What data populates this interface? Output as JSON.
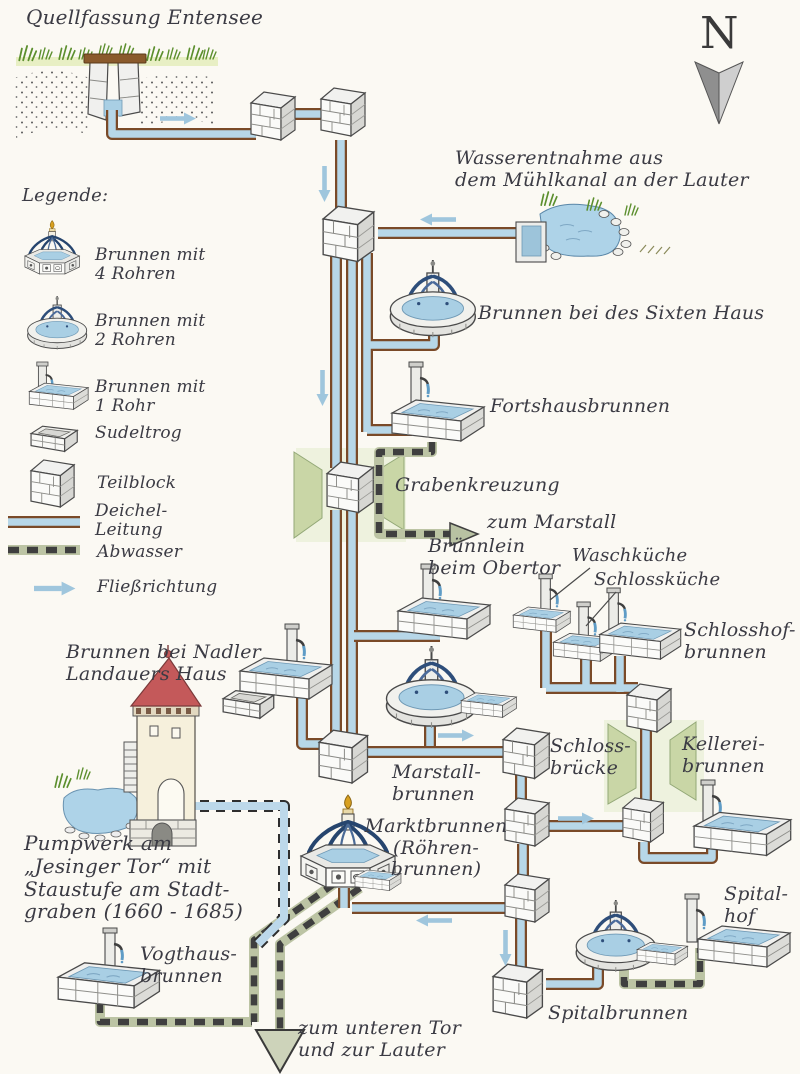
{
  "labels": {
    "quellfassung": "Quellfassung Entensee",
    "wasserentnahme": "Wasserentnahme aus\ndem Mühlkanal an der Lauter",
    "sixten": "Brunnen bei des Sixten Haus",
    "fortshaus": "Fortshausbrunnen",
    "grabenkreuzung": "Grabenkreuzung",
    "zum_marstall": "zum Marstall",
    "bruennlein": "Brünnlein\nbeim Obertor",
    "waschkueche": "Waschküche",
    "schlosskueche": "Schlossküche",
    "schlosshof": "Schlosshof-\nbrunnen",
    "nadler": "Brunnen bei Nadler\nLandauers Haus",
    "marstall": "Marstall-\nbrunnen",
    "schlossbruecke": "Schloss-\nbrücke",
    "kellerei": "Kellerei-\nbrunnen",
    "marktbrunnen": "Marktbrunnen\n(Röhren-\nbrunnen)",
    "pumpwerk": "Pumpwerk am\n„Jesinger Tor“ mit\nStaustufe am Stadt-\ngraben (1660 - 1685)",
    "vogthaus": "Vogthaus-\nbrunnen",
    "zum_unteren_tor": "zum unteren Tor\nund zur Lauter",
    "spitalbrunnen": "Spitalbrunnen",
    "spitalhof": "Spital-\nhof"
  },
  "north": {
    "label": "N"
  },
  "legend": {
    "heading": "Legende:",
    "items": [
      {
        "icon": "fountain-4-pipes-icon",
        "label": "Brunnen mit\n4 Rohren"
      },
      {
        "icon": "fountain-2-pipes-icon",
        "label": "Brunnen mit\n2 Rohren"
      },
      {
        "icon": "fountain-1-pipe-icon",
        "label": "Brunnen mit\n1 Rohr"
      },
      {
        "icon": "sudeltrog-icon",
        "label": "Sudeltrog"
      },
      {
        "icon": "teilblock-icon",
        "label": "Teilblock"
      },
      {
        "icon": "deichel-leitung-icon",
        "label": "Deichel-\nLeitung"
      },
      {
        "icon": "abwasser-icon",
        "label": "Abwasser"
      },
      {
        "icon": "fliessrichtung-icon",
        "label": "Fließrichtung"
      }
    ]
  },
  "colors": {
    "background": "#fbf9f3",
    "ink": "#3b3b44",
    "pipe_water_blue": "#b7d7e8",
    "pipe_edge_brown": "#7a4a28",
    "abwasser_green": "#bcc4a4",
    "dash_dark": "#3f3f3f",
    "flow_arrow_blue": "#9fc6dd",
    "water_blue": "#aed3e8",
    "wedge_green": "#c9d6a6",
    "roof_red": "#c4595a",
    "finial_gold": "#d8a020",
    "stone_gray": "#d7d7d3",
    "grass_green": "#5c8f2e"
  }
}
